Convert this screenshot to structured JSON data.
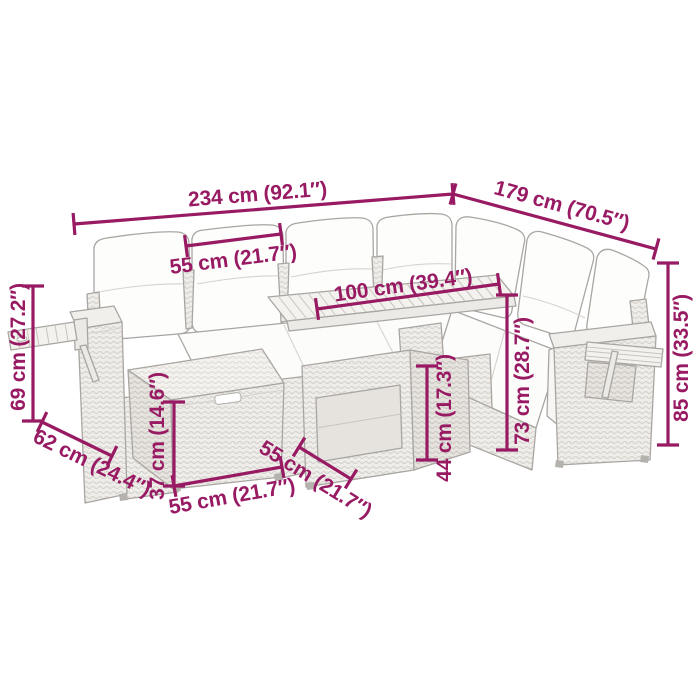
{
  "diagram": {
    "type": "product-dimension-diagram",
    "subject": "rattan garden corner sofa set with footstool and slatted table",
    "background_color": "#ffffff",
    "accent_color": "#981A63",
    "furniture_line_color": "#a9a6a2",
    "dims": {
      "d234": {
        "name": "total-length-left-side",
        "label": "234 cm (92.1″)"
      },
      "d179": {
        "name": "total-length-right-side",
        "label": "179 cm (70.5″)"
      },
      "d55_seat": {
        "name": "seat-width",
        "label": "55 cm (21.7″)"
      },
      "d100": {
        "name": "table-length",
        "label": "100 cm (39.4″)"
      },
      "d69": {
        "name": "armrest-tray-height",
        "label": "69 cm (27.2″)"
      },
      "d62": {
        "name": "armrest-depth",
        "label": "62 cm (24.4″)"
      },
      "d37": {
        "name": "footstool-height",
        "label": "37 cm (14.6″)"
      },
      "d55_stool_w": {
        "name": "footstool-width",
        "label": "55 cm (21.7″)"
      },
      "d55_stool_d": {
        "name": "footstool-depth",
        "label": "55 cm (21.7″)"
      },
      "d44": {
        "name": "table-height",
        "label": "44 cm (17.3″)"
      },
      "d73": {
        "name": "backrest-height",
        "label": "73 cm (28.7″)"
      },
      "d85": {
        "name": "total-height",
        "label": "85 cm (33.5″)"
      }
    }
  }
}
